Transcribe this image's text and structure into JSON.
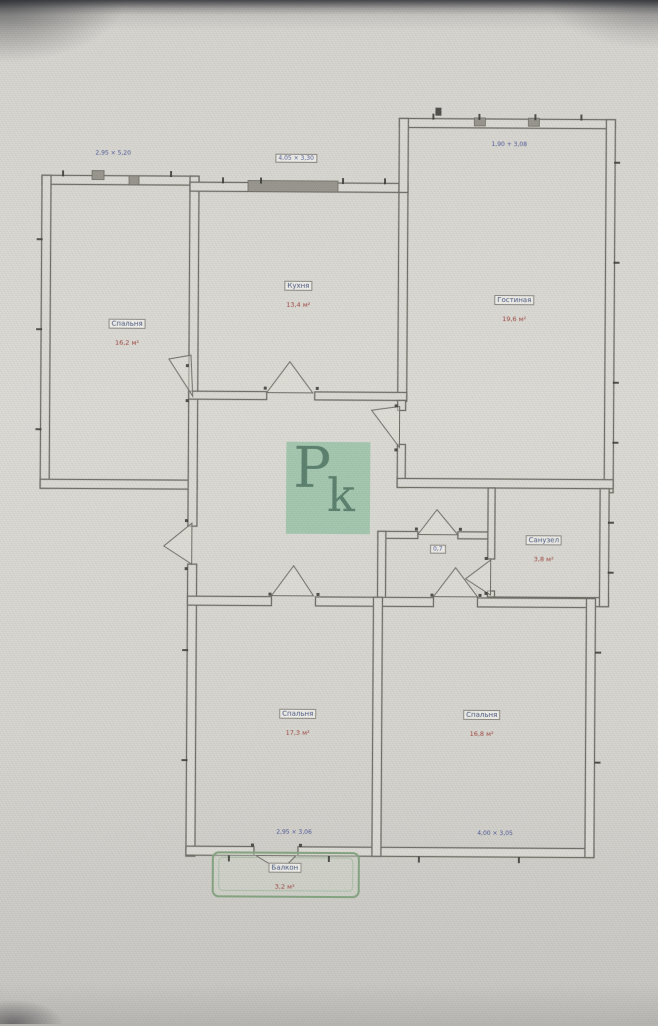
{
  "colors": {
    "wall": "#6b6960",
    "label_blue": "#3d4e7e",
    "label_red": "#a23e37",
    "dimension_blue": "#46549b",
    "balcony_green": "#7fa37b",
    "watermark_bg": "#92c3a3",
    "watermark_fg": "#406c56"
  },
  "watermark": {
    "p": "P",
    "k": "k"
  },
  "rooms": [
    {
      "name": "Спальня",
      "area": "16,2 м²"
    },
    {
      "name": "Кухня",
      "area": "13,4 м²"
    },
    {
      "name": "Гостиная",
      "area": "19,6 м²"
    },
    {
      "name": "Санузел",
      "area": "3,8 м²"
    },
    {
      "name": "Спальня",
      "area": "17,3 м²"
    },
    {
      "name": "Спальня",
      "area": "16,8 м²"
    },
    {
      "name": "Балкон",
      "area": "3,2 м²"
    }
  ],
  "dims": [
    "2,95 × 5,20",
    "4,05 × 3,30",
    "1,90 + 3,08",
    "0,7",
    "2,95 × 3,06",
    "4,00 × 3,05"
  ]
}
